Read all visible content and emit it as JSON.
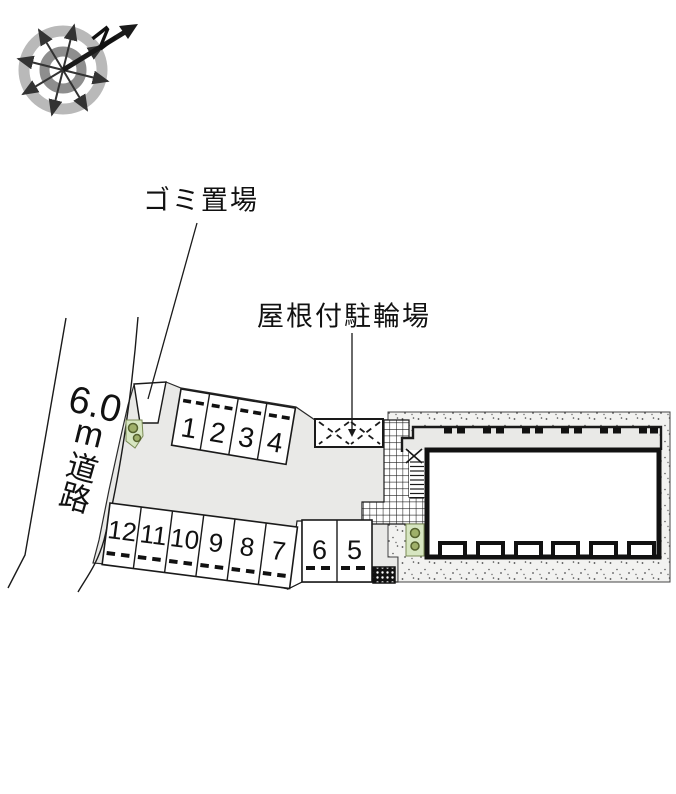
{
  "plan": {
    "compass": {
      "north_label": "N"
    },
    "labels": {
      "garbage": "ゴミ置場",
      "bicycle": "屋根付駐輪場"
    },
    "road": {
      "width_value": "6.0",
      "unit": "m",
      "name_chars": [
        "道",
        "路"
      ]
    },
    "parking": {
      "row_top": [
        "1",
        "2",
        "3",
        "4"
      ],
      "row_bottom": [
        "12",
        "11",
        "10",
        "9",
        "8",
        "7"
      ],
      "row_right": [
        "6",
        "5"
      ]
    },
    "colors": {
      "site_ground": "#e9e9e7",
      "corridor": "#e9e9e7",
      "stipple_ground": "#f2f2f0",
      "green_area": "#d7e6c1",
      "green_icon": "#55622e",
      "ring_outer": "#b9b9b9",
      "ring_inner": "#8e8e8e",
      "line": "#1a1a1a"
    }
  }
}
